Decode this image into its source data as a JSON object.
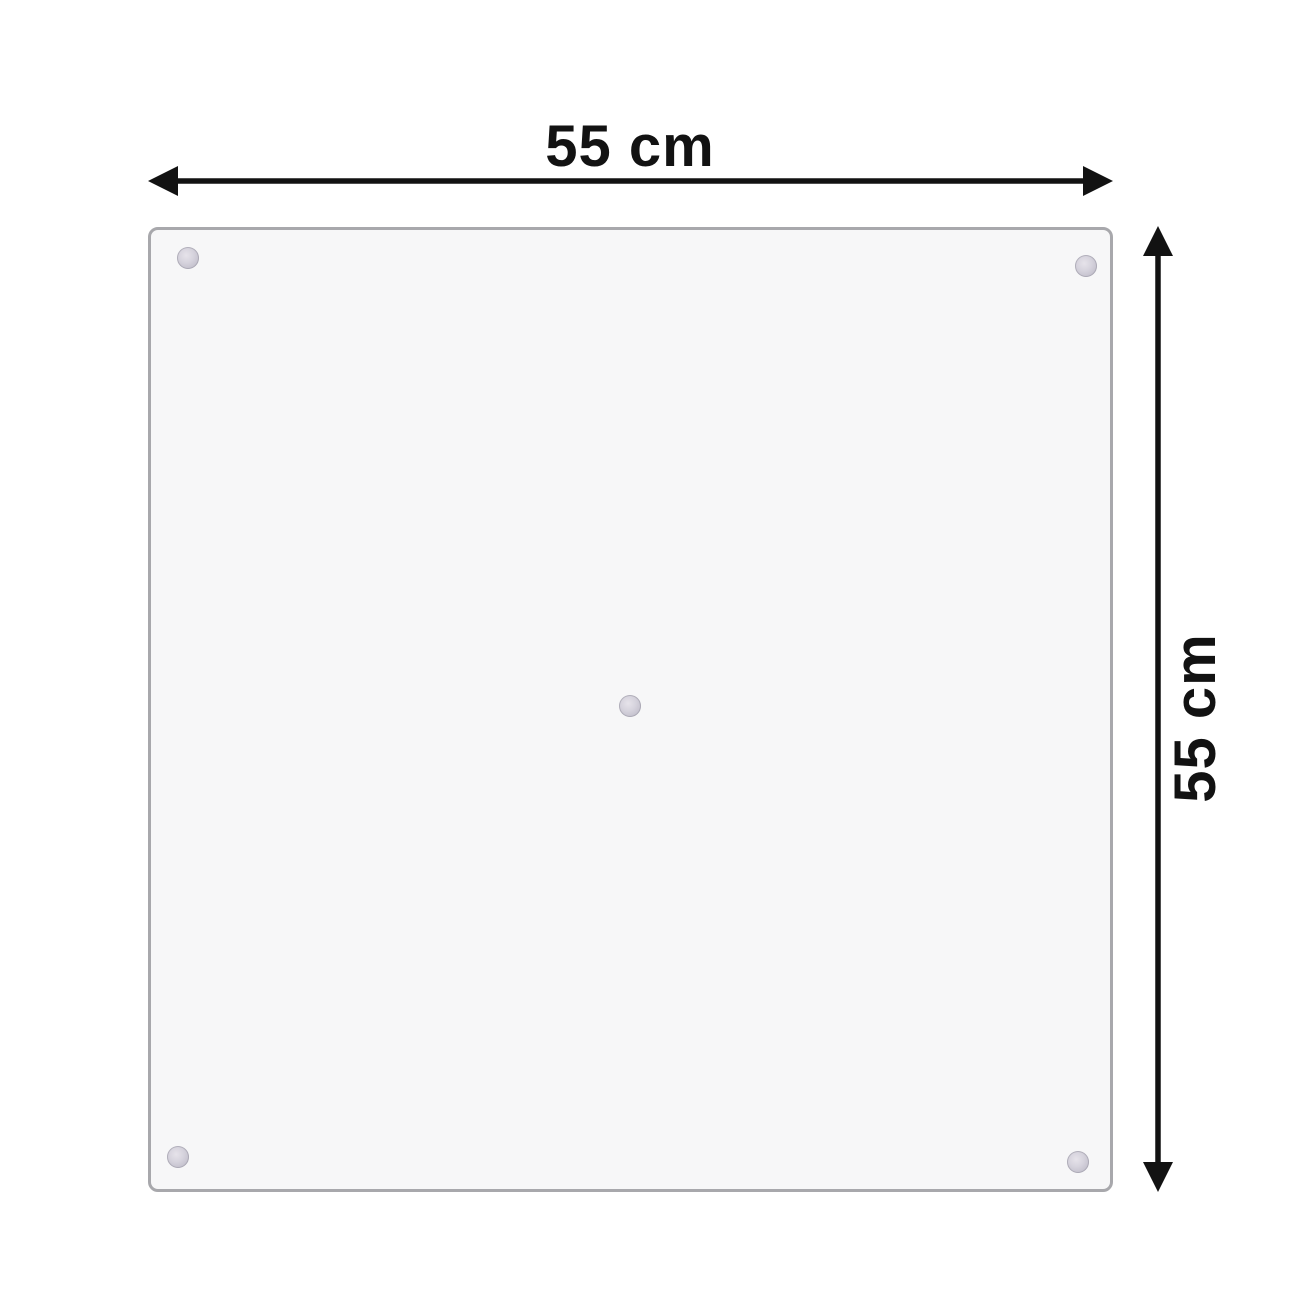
{
  "diagram": {
    "kind": "product-dimension-diagram",
    "width_label": "55 cm",
    "height_label": "55 cm",
    "panel": {
      "shape": "square",
      "suction_cups": [
        "top-left",
        "top-right",
        "bottom-left",
        "bottom-right",
        "center"
      ]
    },
    "colors": {
      "background": "#ffffff",
      "panel_fill": "#f7f7f8",
      "panel_border": "#a8a8ac",
      "arrow": "#121212",
      "suction_cup": "#c9c6d2"
    }
  }
}
